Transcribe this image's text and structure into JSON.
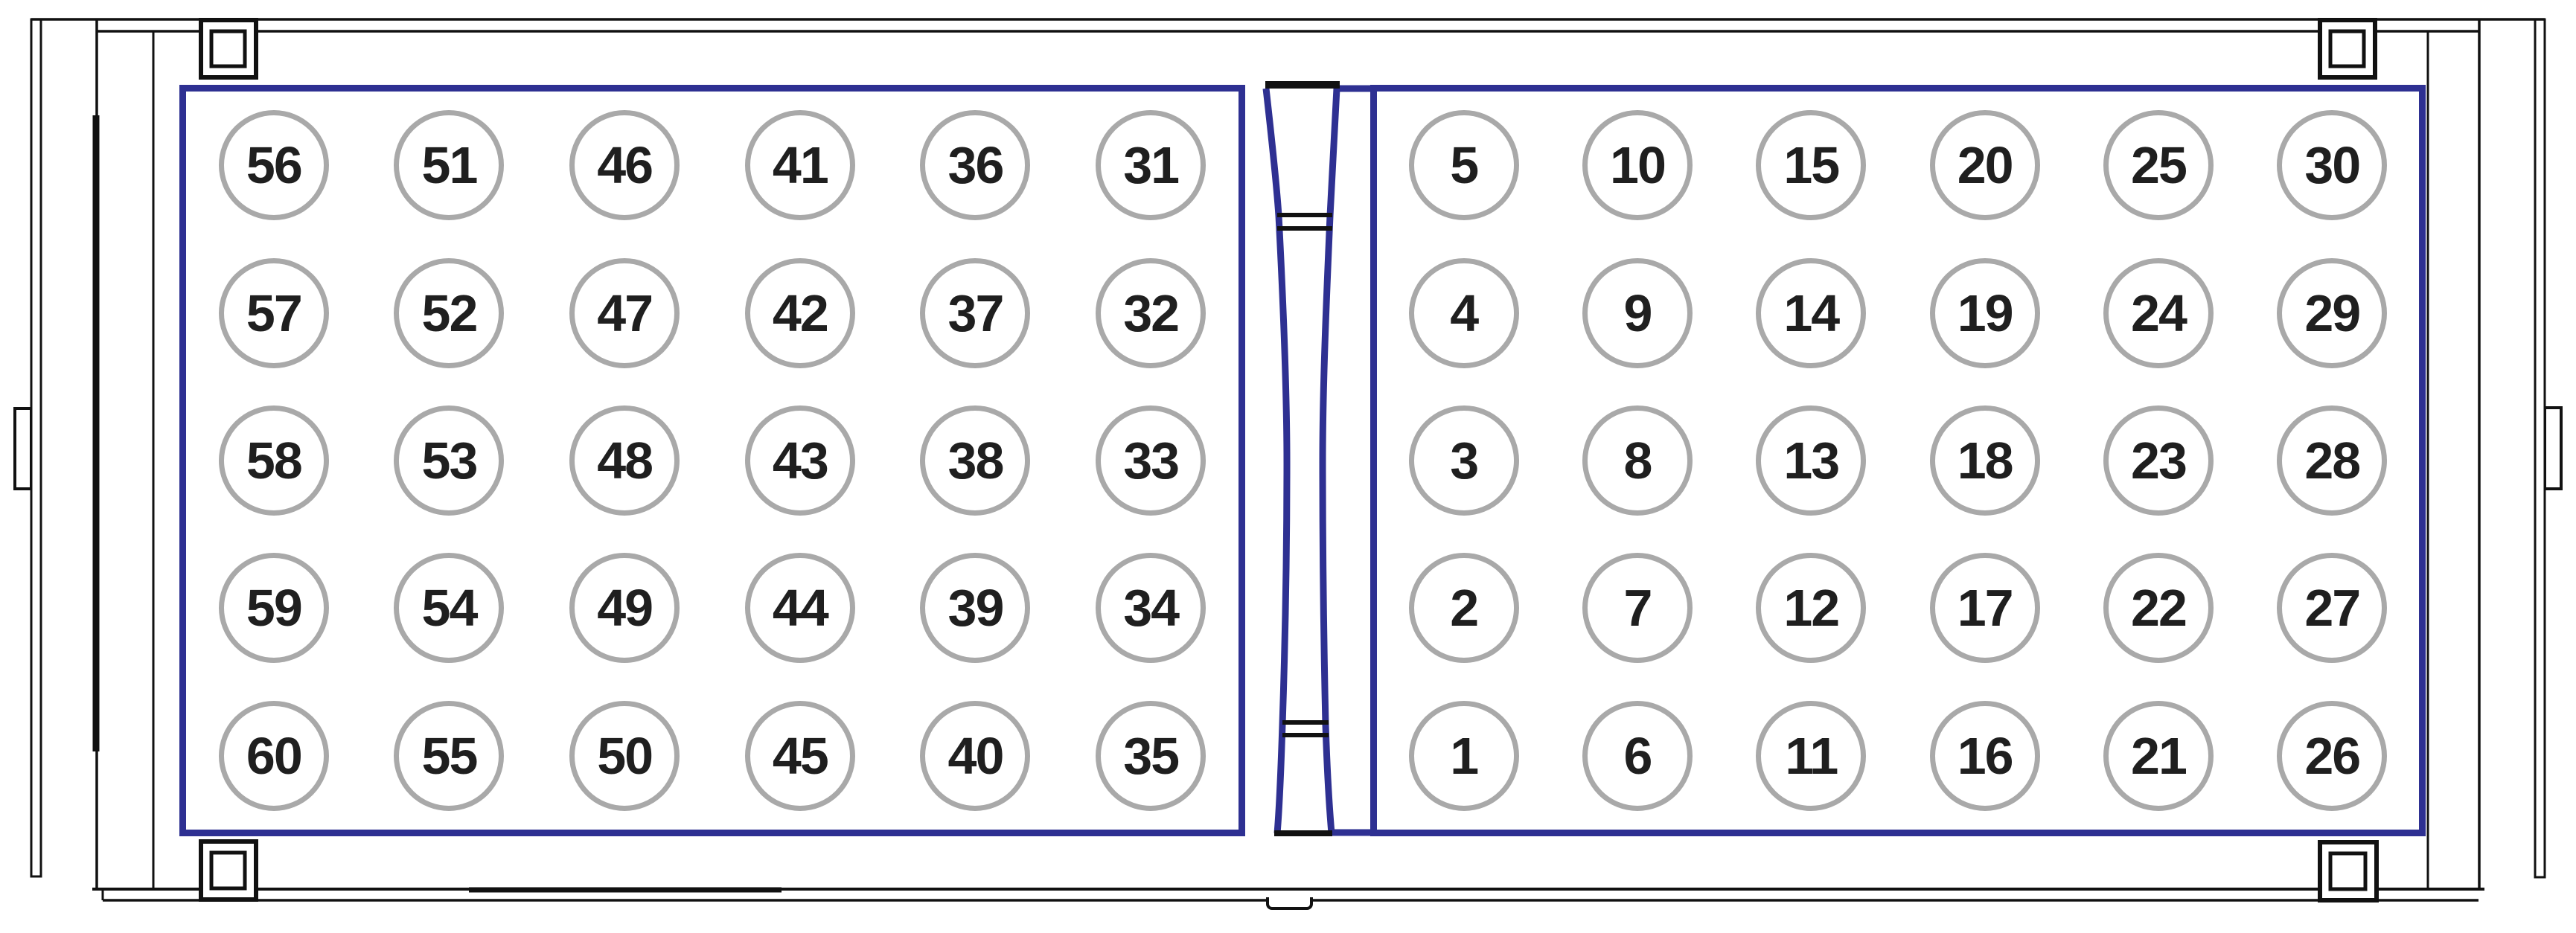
{
  "diagram": {
    "left_panel": {
      "rows": [
        [
          "56",
          "51",
          "46",
          "41",
          "36",
          "31"
        ],
        [
          "57",
          "52",
          "47",
          "42",
          "37",
          "32"
        ],
        [
          "58",
          "53",
          "48",
          "43",
          "38",
          "33"
        ],
        [
          "59",
          "54",
          "49",
          "44",
          "39",
          "34"
        ],
        [
          "60",
          "55",
          "50",
          "45",
          "40",
          "35"
        ]
      ]
    },
    "right_panel": {
      "rows": [
        [
          "5",
          "10",
          "15",
          "20",
          "25",
          "30"
        ],
        [
          "4",
          "9",
          "14",
          "19",
          "24",
          "29"
        ],
        [
          "3",
          "8",
          "13",
          "18",
          "23",
          "28"
        ],
        [
          "2",
          "7",
          "12",
          "17",
          "22",
          "27"
        ],
        [
          "1",
          "6",
          "11",
          "16",
          "21",
          "26"
        ]
      ]
    }
  },
  "colors": {
    "panel_border_blue": "#2e3092",
    "circle_border_gray": "#a9a9a9",
    "outline_black": "#111111",
    "digit_color": "#1f1f1f",
    "background": "#ffffff"
  }
}
